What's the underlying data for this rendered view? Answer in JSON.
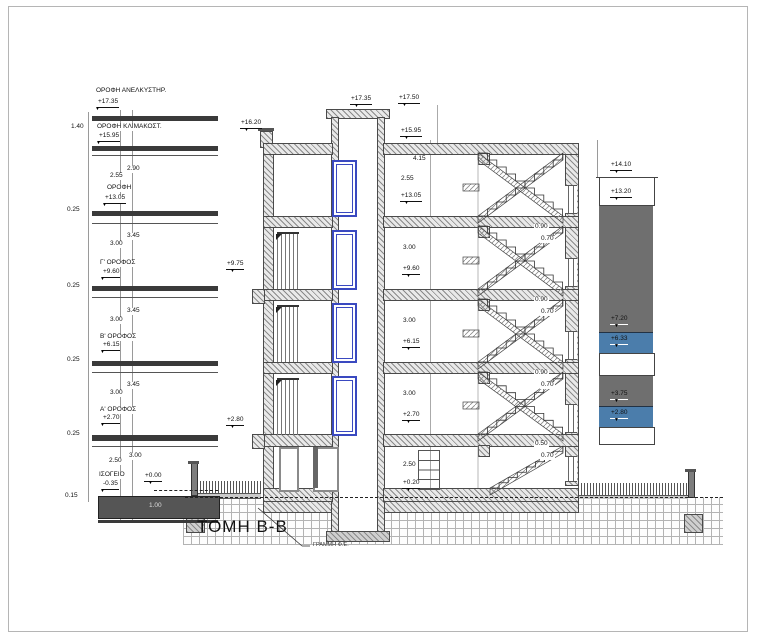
{
  "drawing": {
    "title": "ΤΟΜΗ Β-Β",
    "ground_line_note": "ΓΡΑΜΜΗ Φ.Ε.",
    "marker_glyph": "▼"
  },
  "ladder": {
    "levels": [
      {
        "name": "ΟΡΟΦΗ ΑΝΕΛΚΥΣΤΗΡ.",
        "elev": "+17.35"
      },
      {
        "name": "ΟΡΟΦΗ ΚΛΙΜΑΚΟΣΤ.",
        "elev": "+15.95"
      },
      {
        "name": "ΟΡΟΦΗ",
        "elev": "+13.05"
      },
      {
        "name": "Γ' ΟΡΟΦΟΣ",
        "elev": "+9.60"
      },
      {
        "name": "Β' ΟΡΟΦΟΣ",
        "elev": "+6.15"
      },
      {
        "name": "Α' ΟΡΟΦΟΣ",
        "elev": "+2.70"
      },
      {
        "name": "ΙΣΟΓΕΙΟ",
        "elev": "-0.35"
      }
    ],
    "zero": "+0.00",
    "dims": {
      "roof_gap": "1.40",
      "upper_clear": "2.55",
      "upper_floor": "2.90",
      "slab": "0.25",
      "clear": "3.00",
      "floor": "3.45",
      "ground_clear": "2.50",
      "ground_floor": "3.00",
      "base": "0.15",
      "foundation": "1.00"
    }
  },
  "section": {
    "elev": {
      "shaft_slab": "+17.35",
      "shaft_top": "+17.50",
      "parapet": "+16.20",
      "roof": "+15.95",
      "floor4": "+13.05",
      "floor3": "+9.60",
      "floor2": "+6.15",
      "floor1": "+2.70",
      "entry": "+0.20",
      "balcony_upper": "+9.75",
      "balcony_lower": "+2.80"
    },
    "dims": {
      "total_top": "4.15",
      "clear_top": "2.55",
      "clear": "3.00",
      "ground_clear": "2.50",
      "sill": "0.90",
      "win": "0.70",
      "sill_low": "0.50"
    }
  },
  "neighbor": {
    "elev": {
      "top": "+14.10",
      "roof": "+13.20",
      "win_up_top": "+7.20",
      "win_up": "+6.33",
      "win_low_top": "+3.75",
      "win_low": "+2.80"
    }
  },
  "colors": {
    "slab_dark": "#3a3a3a",
    "neighbor_gray": "#6f6f6f",
    "panel_blue": "#4b7dab",
    "window_blue": "#3a49c0",
    "hatch_line": "#8a8a8a"
  }
}
